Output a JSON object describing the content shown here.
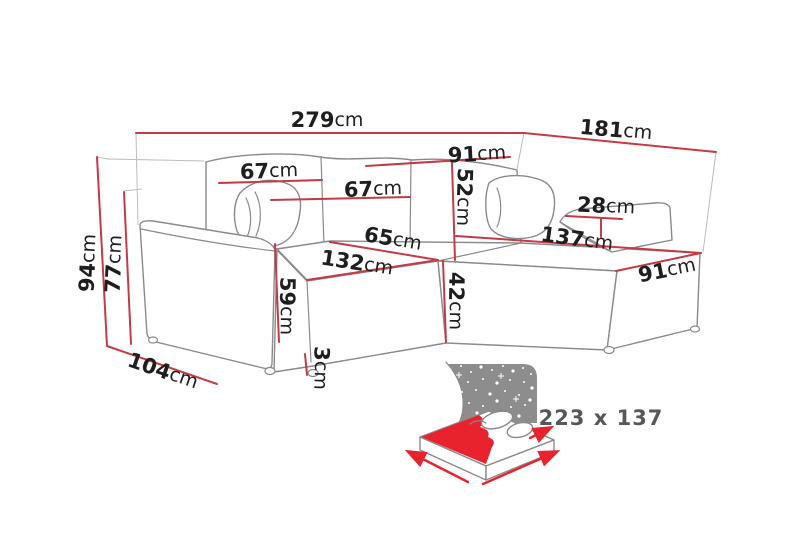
{
  "diagram": {
    "type": "corner-sofa-dimension-diagram",
    "unit": "cm",
    "colors": {
      "dimension_line": "#c43a46",
      "sofa_outline": "#8a8a8a",
      "guide_line": "#bcbcbc",
      "label_text": "#1e1e1e",
      "accent_red": "#e8232e",
      "bed_label_text": "#57575a",
      "background": "#ffffff"
    },
    "dims": {
      "total_width": {
        "value": "279",
        "unit": "cm"
      },
      "total_depth": {
        "value": "181",
        "unit": "cm"
      },
      "back_height": {
        "value": "91",
        "unit": "cm"
      },
      "backrest_height": {
        "value": "52",
        "unit": "cm"
      },
      "back_cushion_left_width": {
        "value": "67",
        "unit": "cm"
      },
      "back_cushion_middle_width": {
        "value": "67",
        "unit": "cm"
      },
      "seat_depth": {
        "value": "65",
        "unit": "cm"
      },
      "seat_width": {
        "value": "132",
        "unit": "cm"
      },
      "right_armrest_width": {
        "value": "28",
        "unit": "cm"
      },
      "chaise_length": {
        "value": "137",
        "unit": "cm"
      },
      "chaise_width": {
        "value": "91",
        "unit": "cm"
      },
      "total_height": {
        "value": "94",
        "unit": "cm"
      },
      "armrest_height": {
        "value": "77",
        "unit": "cm"
      },
      "side_depth": {
        "value": "104",
        "unit": "cm"
      },
      "seat_height": {
        "value": "59",
        "unit": "cm"
      },
      "front_height": {
        "value": "42",
        "unit": "cm"
      },
      "leg_height": {
        "value": "3",
        "unit": "cm"
      }
    },
    "sleeping_function": {
      "icon": "sofa-bed-night-icon",
      "size_label": "223 x 137"
    }
  }
}
